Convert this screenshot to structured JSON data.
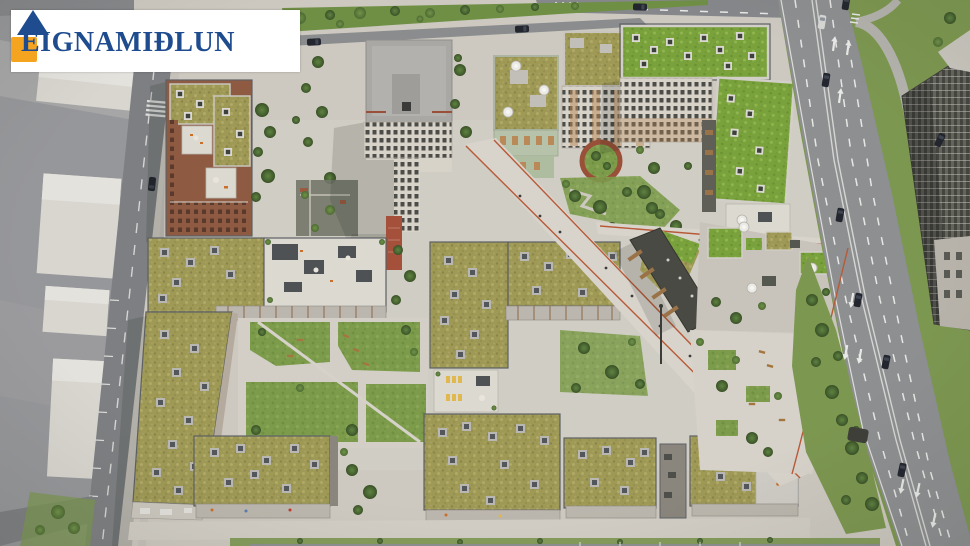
{
  "watermark": {
    "brand": "EIGNAMIÐLUN",
    "icon": "house-icon",
    "plate_color": "#ffffff",
    "text_color": "#1e4c8f",
    "roof_color": "#1e4c8f",
    "body_color": "#f5a41f"
  },
  "scene": {
    "type": "aerial-architectural-render",
    "palette": {
      "pavement": "#cdc9c1",
      "plaza": "#d6d2ca",
      "asphalt": "#8d8f91",
      "local_street": "#7d7f82",
      "sedum_roof_olive": "#9f9956",
      "sedum_roof_bright": "#7aa23c",
      "lawn": "#7c9c4b",
      "tree_green": "#47632f",
      "brick_red": "#8e5a42",
      "roof_terrace_white": "#dcd9d1",
      "sage_facade": "#b7c2aa",
      "wood_balcony": "#b98a58",
      "dark_facade": "#4a4a44",
      "grass_verge": "#7c9750",
      "lane_marking": "#e7e7e5",
      "path_edge_red": "#b85a38"
    }
  }
}
